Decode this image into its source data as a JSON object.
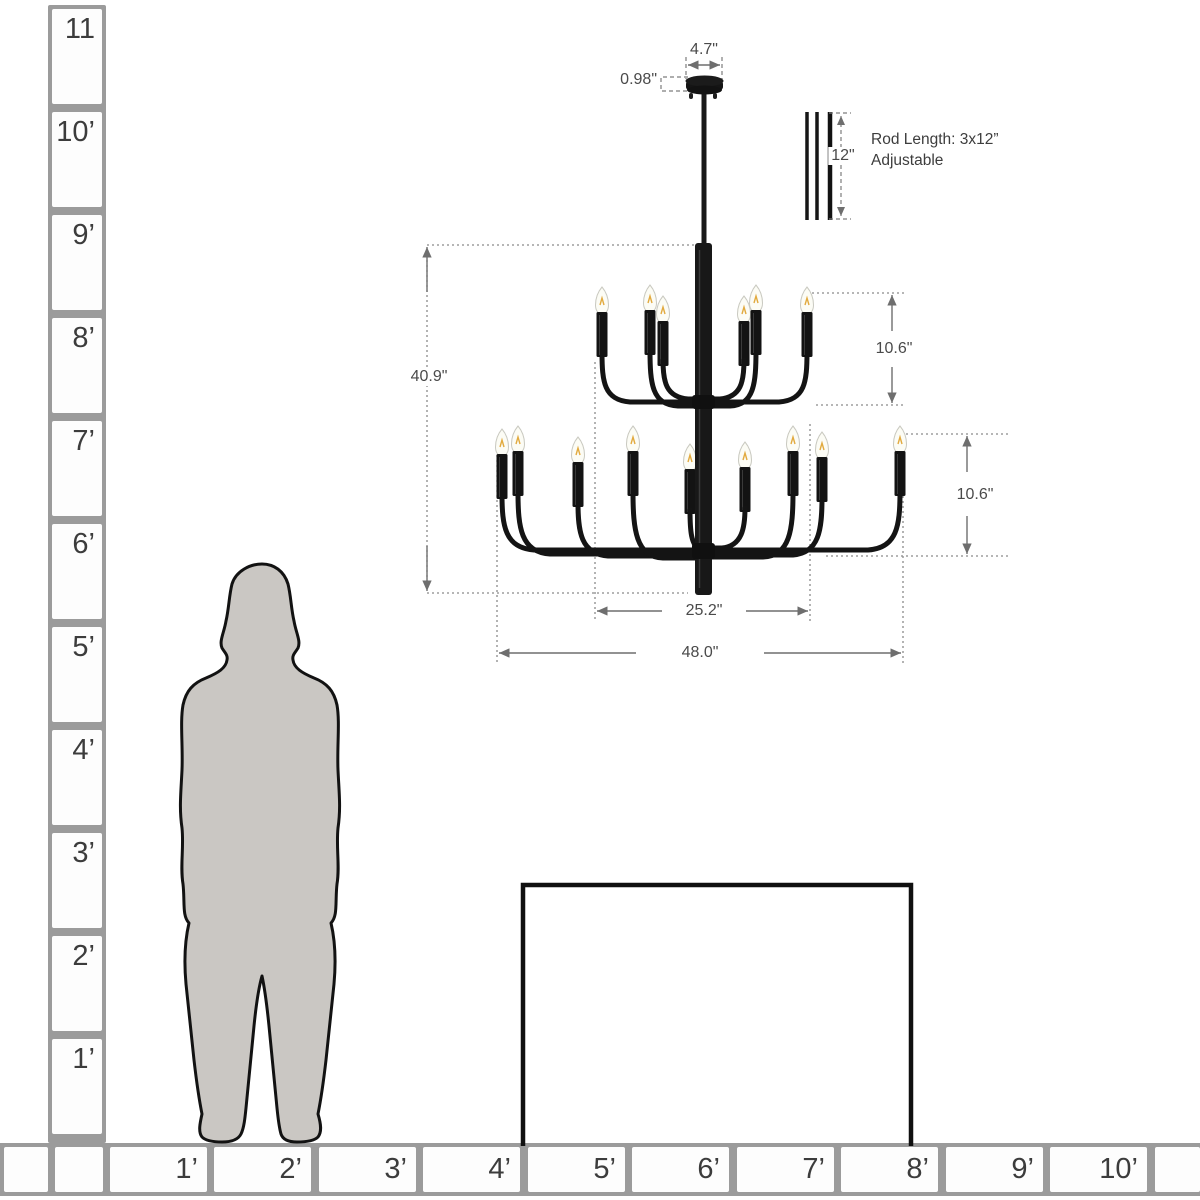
{
  "diagram_title": "chandelier-size-comparison-diagram",
  "dimensions": {
    "canopy_width": "4.7\"",
    "canopy_height": "0.98\"",
    "rod_segment": "12\"",
    "rod_note_line1": "Rod Length: 3x12”",
    "rod_note_line2": "Adjustable",
    "fixture_height": "40.9\"",
    "tier1_height": "10.6\"",
    "tier2_height": "10.6\"",
    "tier1_width": "25.2\"",
    "fixture_width": "48.0\""
  },
  "ruler_left": {
    "labels": [
      "11",
      "10’",
      "9’",
      "8’",
      "7’",
      "6’",
      "5’",
      "4’",
      "3’",
      "2’",
      "1’"
    ]
  },
  "ruler_bottom": {
    "labels": [
      "1’",
      "2’",
      "3’",
      "4’",
      "5’",
      "6’",
      "7’",
      "8’",
      "9’",
      "10’"
    ]
  },
  "colors": {
    "chandelier": "#141414",
    "silhouette_fill": "#cac7c3",
    "ruler_grid": "#9b9b9b",
    "dimension_lines": "#6e6e6e",
    "bulb_filament": "#e2aa3f",
    "background": "#ffffff"
  }
}
